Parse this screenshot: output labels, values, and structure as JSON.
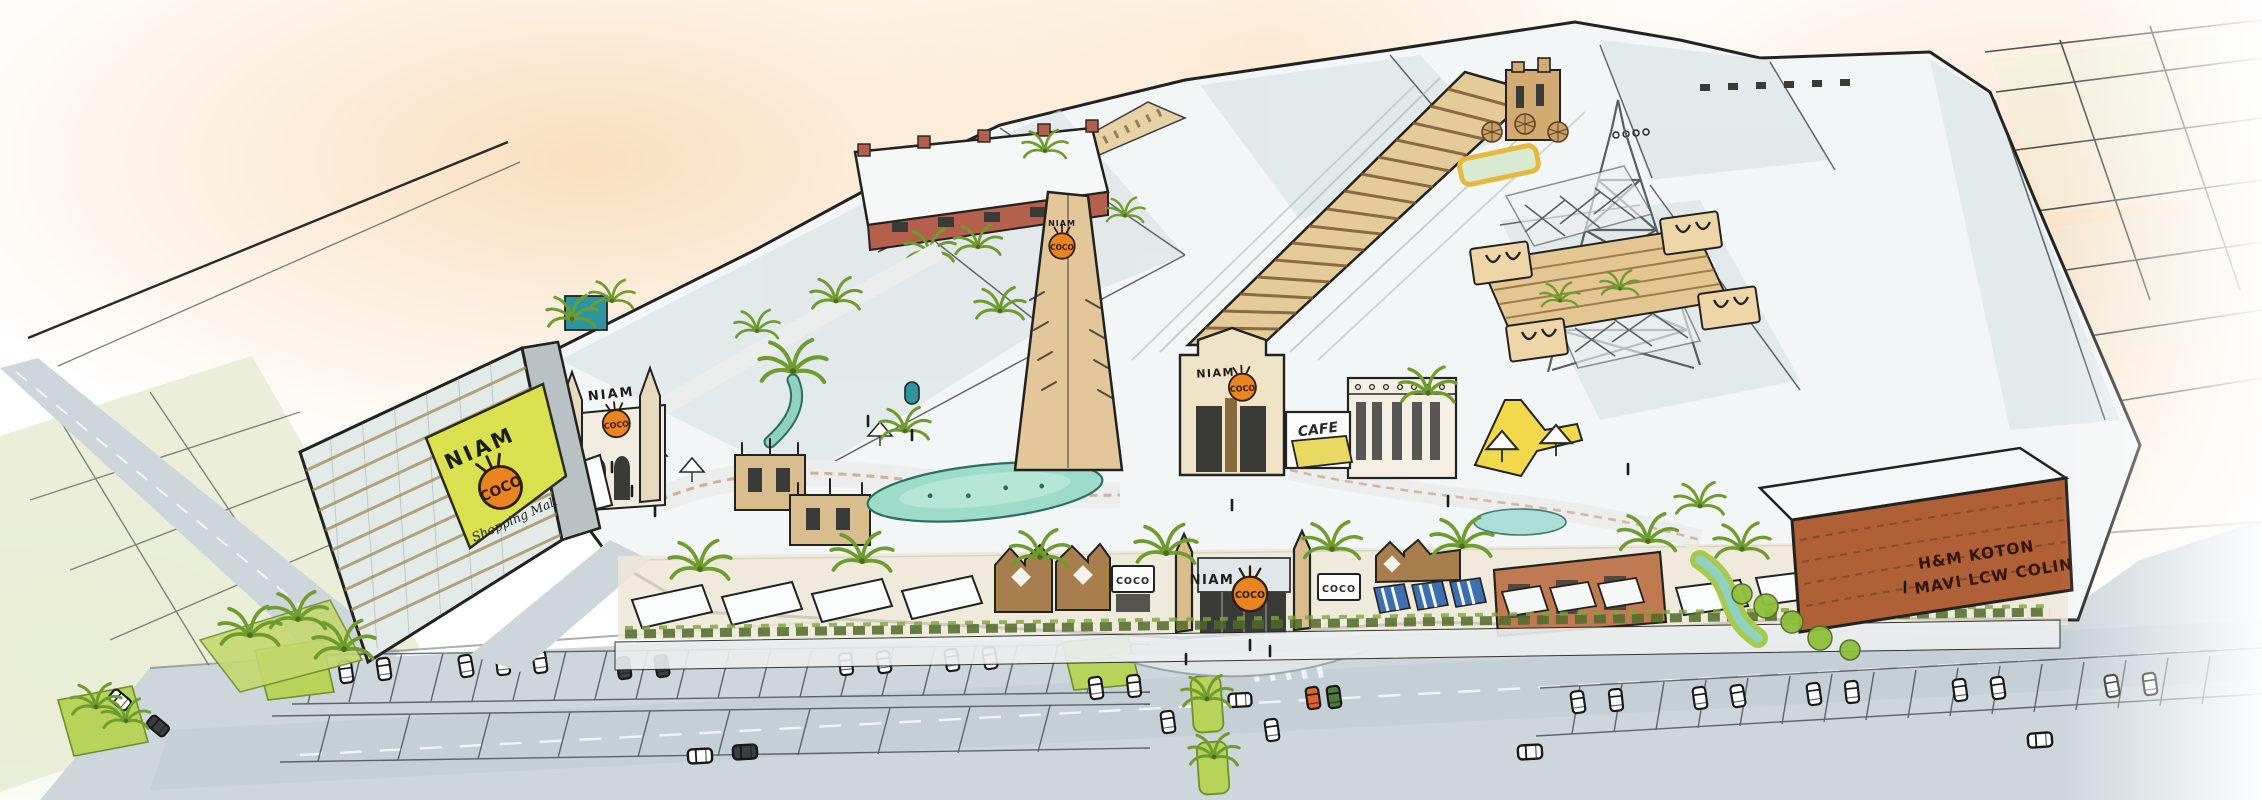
{
  "scene": {
    "subject": "NIAM COCO Shopping Mall",
    "view": "hand-drawn aerial concept rendering"
  },
  "branding": {
    "niam": "NIAM",
    "coco": "COCO",
    "tagline": "Shopping Mall"
  },
  "signs": {
    "cafe": "CAFE",
    "coco_board_left": "COCO",
    "coco_board_right": "COCO"
  },
  "anchors": {
    "line1": "H&M  KOTON",
    "line2": "MAVI  LCW  COLIN",
    "tenants": [
      "H&M",
      "KOTON",
      "MAVI",
      "LCW",
      "COLIN"
    ]
  },
  "colors": {
    "paper": "#ffffff",
    "peach_wash": "#f6cb98",
    "ink": "#222220",
    "roof_white": "#f3f6f6",
    "roof_shade": "#d9e2e5",
    "tan_facade": "#e3c79b",
    "brown_ornate": "#a87e4e",
    "terracotta_shop": "#c07a52",
    "anchor_corten": "#b06036",
    "red_parapet": "#b5604c",
    "logo_orange": "#e98420",
    "banner_green": "#d9e14f",
    "palm_green": "#6f9c2e",
    "lawn_green": "#b7d35a",
    "water_turquoise": "#8fd2c0",
    "road_grey": "#c9d3d9",
    "awning_blue": "#3e6fae",
    "awning_yellow": "#e9d861",
    "lot_pale_green": "#e7ecd4"
  }
}
